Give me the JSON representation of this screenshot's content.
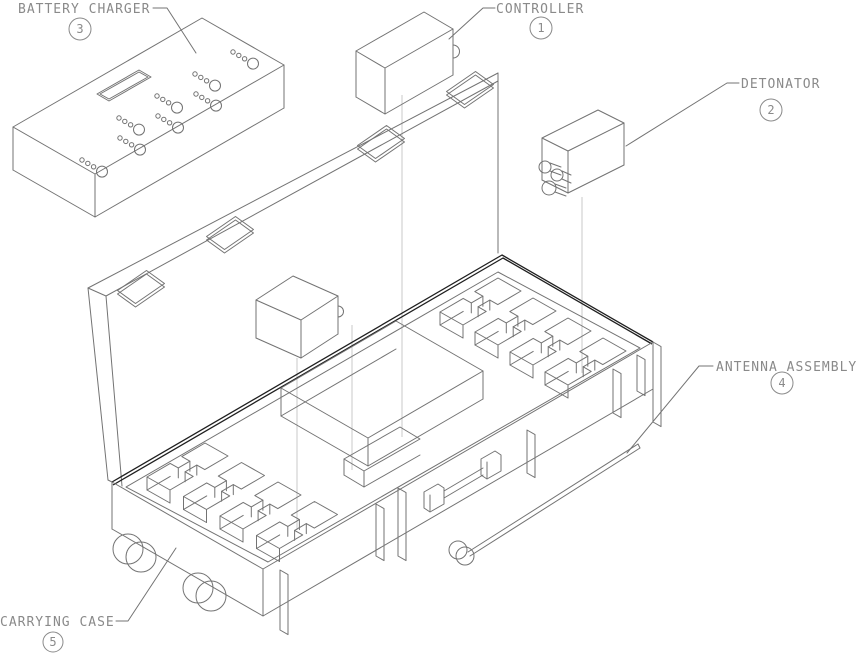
{
  "diagram": {
    "type": "exploded-parts-diagram",
    "callouts": [
      {
        "id": "controller",
        "label": "CONTROLLER",
        "number": "1"
      },
      {
        "id": "detonator",
        "label": "DETONATOR",
        "number": "2"
      },
      {
        "id": "battery-charger",
        "label": "BATTERY CHARGER",
        "number": "3"
      },
      {
        "id": "antenna-assembly",
        "label": "ANTENNA ASSEMBLY",
        "number": "4"
      },
      {
        "id": "carrying-case",
        "label": "CARRYING CASE",
        "number": "5"
      }
    ],
    "colors": {
      "line": "#737373",
      "thick_line": "#1f1f1f",
      "light_line": "#c9c9c9",
      "text": "#8a8a8a",
      "background": "#ffffff"
    }
  }
}
